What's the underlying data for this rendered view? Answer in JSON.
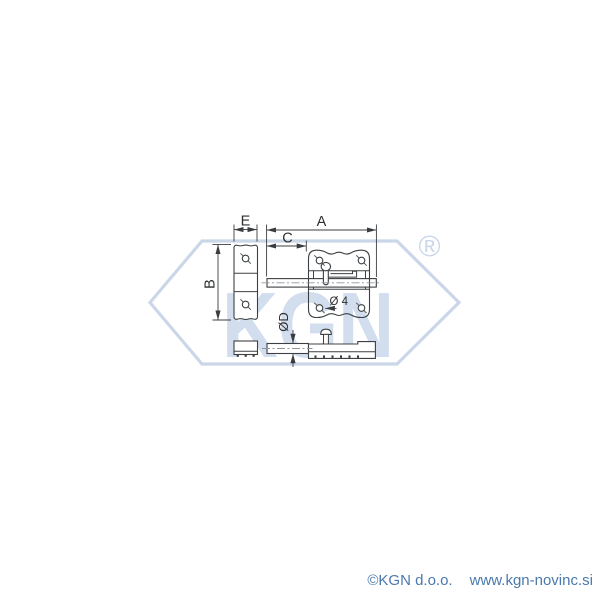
{
  "dimensions": {
    "a": "A",
    "b": "B",
    "c": "C",
    "e": "E",
    "rod_diameter": "ØD",
    "hole_diameter": "Ø 4"
  },
  "watermark": {
    "logo_text": "KGN",
    "registered": "®",
    "color": "#cbd7e9",
    "letters_color": "#d2ddee"
  },
  "drawing": {
    "line_color": "#3c4043",
    "dimension_color": "#3a3d40"
  },
  "footer": {
    "copyright": "©KGN d.o.o.",
    "website": "www.kgn-novinc.si",
    "color": "#4a79ae"
  }
}
